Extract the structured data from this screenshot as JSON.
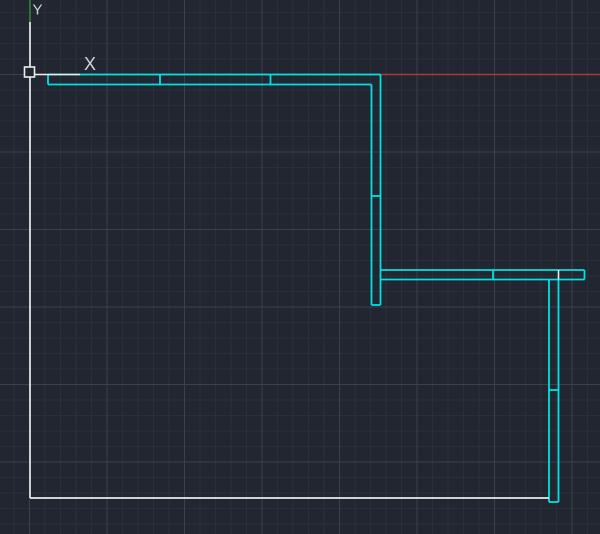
{
  "canvas": {
    "width": 600,
    "height": 534,
    "background_color": "#212631",
    "grid": {
      "minor_spacing": 15.5,
      "major_every": 5,
      "origin_x": 29.5,
      "origin_y": 74.5,
      "minor_color": "#2a303b",
      "major_color": "#39404e"
    }
  },
  "colors": {
    "cyan": "#00e2e2",
    "white": "#e9ebed",
    "red": "#a63c38",
    "green": "#2f8038",
    "label": "#cfd3d7"
  },
  "axis_labels": [
    {
      "text": "Y",
      "x": 37.5,
      "y": 10,
      "font_size": 15
    },
    {
      "text": "X",
      "x": 90,
      "y": 64,
      "font_size": 18
    }
  ],
  "origin_marker": {
    "x": 24.5,
    "y": 67,
    "size": 10,
    "stroke_width": 1.6
  },
  "segments": [
    {
      "name": "red-construction-line",
      "color": "red",
      "x1": 30,
      "y1": 74.5,
      "x2": 600,
      "y2": 74.5,
      "w": 1.4
    },
    {
      "name": "green-construction-line",
      "color": "green",
      "x1": 30,
      "y1": 0,
      "x2": 30,
      "y2": 22,
      "w": 1.6
    },
    {
      "name": "wall-top-outer-edge",
      "color": "cyan",
      "x1": 48,
      "y1": 74.5,
      "x2": 380.5,
      "y2": 74.5,
      "w": 1.8
    },
    {
      "name": "wall-top-left-cap",
      "color": "cyan",
      "x1": 48,
      "y1": 74.5,
      "x2": 48,
      "y2": 84.5,
      "w": 1.8
    },
    {
      "name": "wall-top-inner-edge",
      "color": "cyan",
      "x1": 48,
      "y1": 84.5,
      "x2": 371.5,
      "y2": 84.5,
      "w": 1.8
    },
    {
      "name": "wall-top-joint-divider-1",
      "color": "cyan",
      "x1": 160,
      "y1": 74.5,
      "x2": 160,
      "y2": 84.5,
      "w": 1.8
    },
    {
      "name": "wall-top-joint-divider-2",
      "color": "cyan",
      "x1": 270.5,
      "y1": 74.5,
      "x2": 270.5,
      "y2": 84.5,
      "w": 1.8
    },
    {
      "name": "wall1-left-edge",
      "color": "cyan",
      "x1": 371.5,
      "y1": 84.5,
      "x2": 371.5,
      "y2": 305,
      "w": 1.8
    },
    {
      "name": "wall1-right-edge",
      "color": "cyan",
      "x1": 380.5,
      "y1": 74.5,
      "x2": 380.5,
      "y2": 305,
      "w": 1.8
    },
    {
      "name": "wall1-bottom-cap",
      "color": "cyan",
      "x1": 371.5,
      "y1": 305,
      "x2": 380.5,
      "y2": 305,
      "w": 1.8
    },
    {
      "name": "wall1-joint-divider",
      "color": "cyan",
      "x1": 371.5,
      "y1": 196,
      "x2": 380.5,
      "y2": 196,
      "w": 1.8
    },
    {
      "name": "wall2-top-edge",
      "color": "cyan",
      "x1": 380.5,
      "y1": 270,
      "x2": 584.5,
      "y2": 270,
      "w": 1.8
    },
    {
      "name": "wall2-bottom-edge",
      "color": "cyan",
      "x1": 380.5,
      "y1": 279.5,
      "x2": 584.5,
      "y2": 279.5,
      "w": 1.8
    },
    {
      "name": "wall2-right-cap",
      "color": "cyan",
      "x1": 584.5,
      "y1": 270,
      "x2": 584.5,
      "y2": 279.5,
      "w": 1.8
    },
    {
      "name": "wall2-joint-divider",
      "color": "cyan",
      "x1": 493,
      "y1": 270,
      "x2": 493,
      "y2": 279.5,
      "w": 1.8
    },
    {
      "name": "wall3-left-edge",
      "color": "cyan",
      "x1": 549,
      "y1": 279.5,
      "x2": 549,
      "y2": 502,
      "w": 1.8
    },
    {
      "name": "wall3-right-edge",
      "color": "cyan",
      "x1": 558.5,
      "y1": 279.5,
      "x2": 558.5,
      "y2": 502,
      "w": 1.8
    },
    {
      "name": "wall3-bottom-cap",
      "color": "cyan",
      "x1": 549,
      "y1": 502,
      "x2": 558.5,
      "y2": 502,
      "w": 1.8
    },
    {
      "name": "wall3-joint-divider",
      "color": "cyan",
      "x1": 549,
      "y1": 390,
      "x2": 558.5,
      "y2": 390,
      "w": 1.8
    },
    {
      "name": "boundary-left-line",
      "color": "white",
      "x1": 30,
      "y1": 22,
      "x2": 30,
      "y2": 498,
      "w": 1.7
    },
    {
      "name": "boundary-bottom-line",
      "color": "white",
      "x1": 30,
      "y1": 498,
      "x2": 549,
      "y2": 498,
      "w": 1.7
    },
    {
      "name": "ucs-x-axis-arm",
      "color": "white",
      "x1": 34.5,
      "y1": 74.5,
      "x2": 80,
      "y2": 74.5,
      "w": 1.6
    },
    {
      "name": "wall3-white-joint-divider",
      "color": "white",
      "x1": 558.5,
      "y1": 270,
      "x2": 558.5,
      "y2": 279.5,
      "w": 1.6
    }
  ]
}
